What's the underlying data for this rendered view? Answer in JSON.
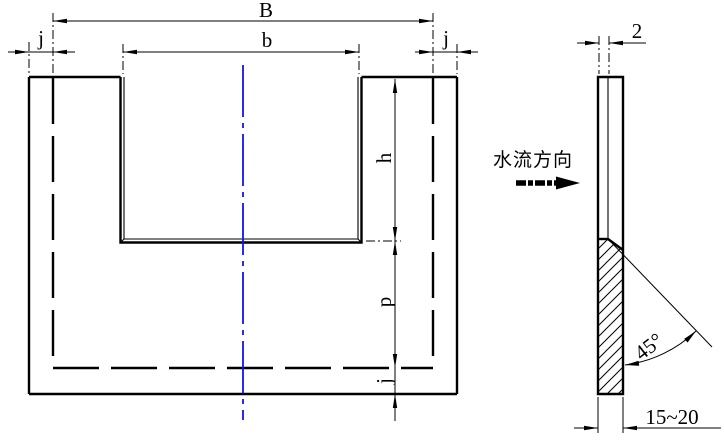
{
  "drawing": {
    "front_view": {
      "dims": {
        "B": "B",
        "b": "b",
        "j_top_left": "j",
        "j_top_right": "j",
        "h": "h",
        "p": "p",
        "j_bottom": "j"
      }
    },
    "side_view": {
      "dims": {
        "crest_thickness": "2",
        "bevel_angle": "45°",
        "plate_thickness": "15~20"
      },
      "flow_direction_label": "水流方向"
    },
    "colors": {
      "line": "#000000",
      "centerline": "#1212ee",
      "background": "#ffffff"
    }
  }
}
